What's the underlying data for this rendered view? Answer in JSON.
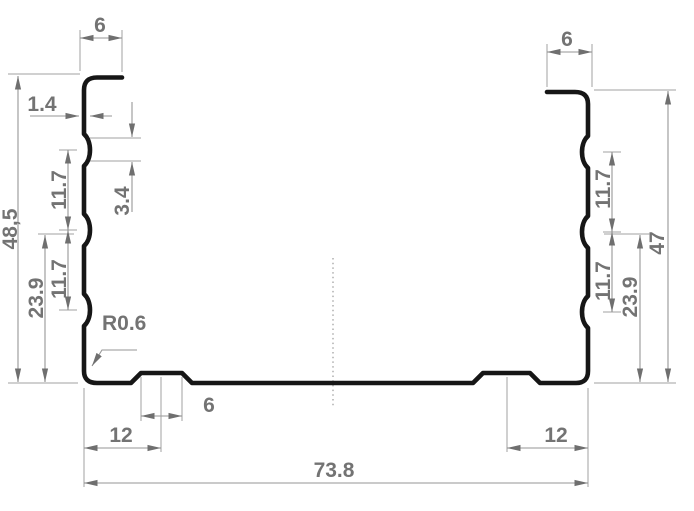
{
  "drawing": {
    "description": "dimensioned cross-section of a cold-formed steel channel profile",
    "colors": {
      "background": "#ffffff",
      "profile_line": "#161616",
      "dimension_line": "#969696",
      "label_text": "#737373"
    },
    "labels": {
      "top_left_lip_width": "6",
      "top_right_lip_width": "6",
      "material_thickness": "1.4",
      "bead_height": "3.4",
      "left_bead_spacing_upper": "11.7",
      "left_bead_spacing_lower": "11.7",
      "left_bead_to_base": "23.9",
      "overall_height_left": "48,5",
      "right_bead_spacing_upper": "11.7",
      "right_bead_spacing_lower": "11.7",
      "right_bead_to_base": "23.9",
      "overall_height_right": "47",
      "corner_radius": "R0.6",
      "base_rib_width": "6",
      "base_rib_offset_left": "12",
      "base_rib_offset_right": "12",
      "overall_width": "73.8"
    }
  }
}
